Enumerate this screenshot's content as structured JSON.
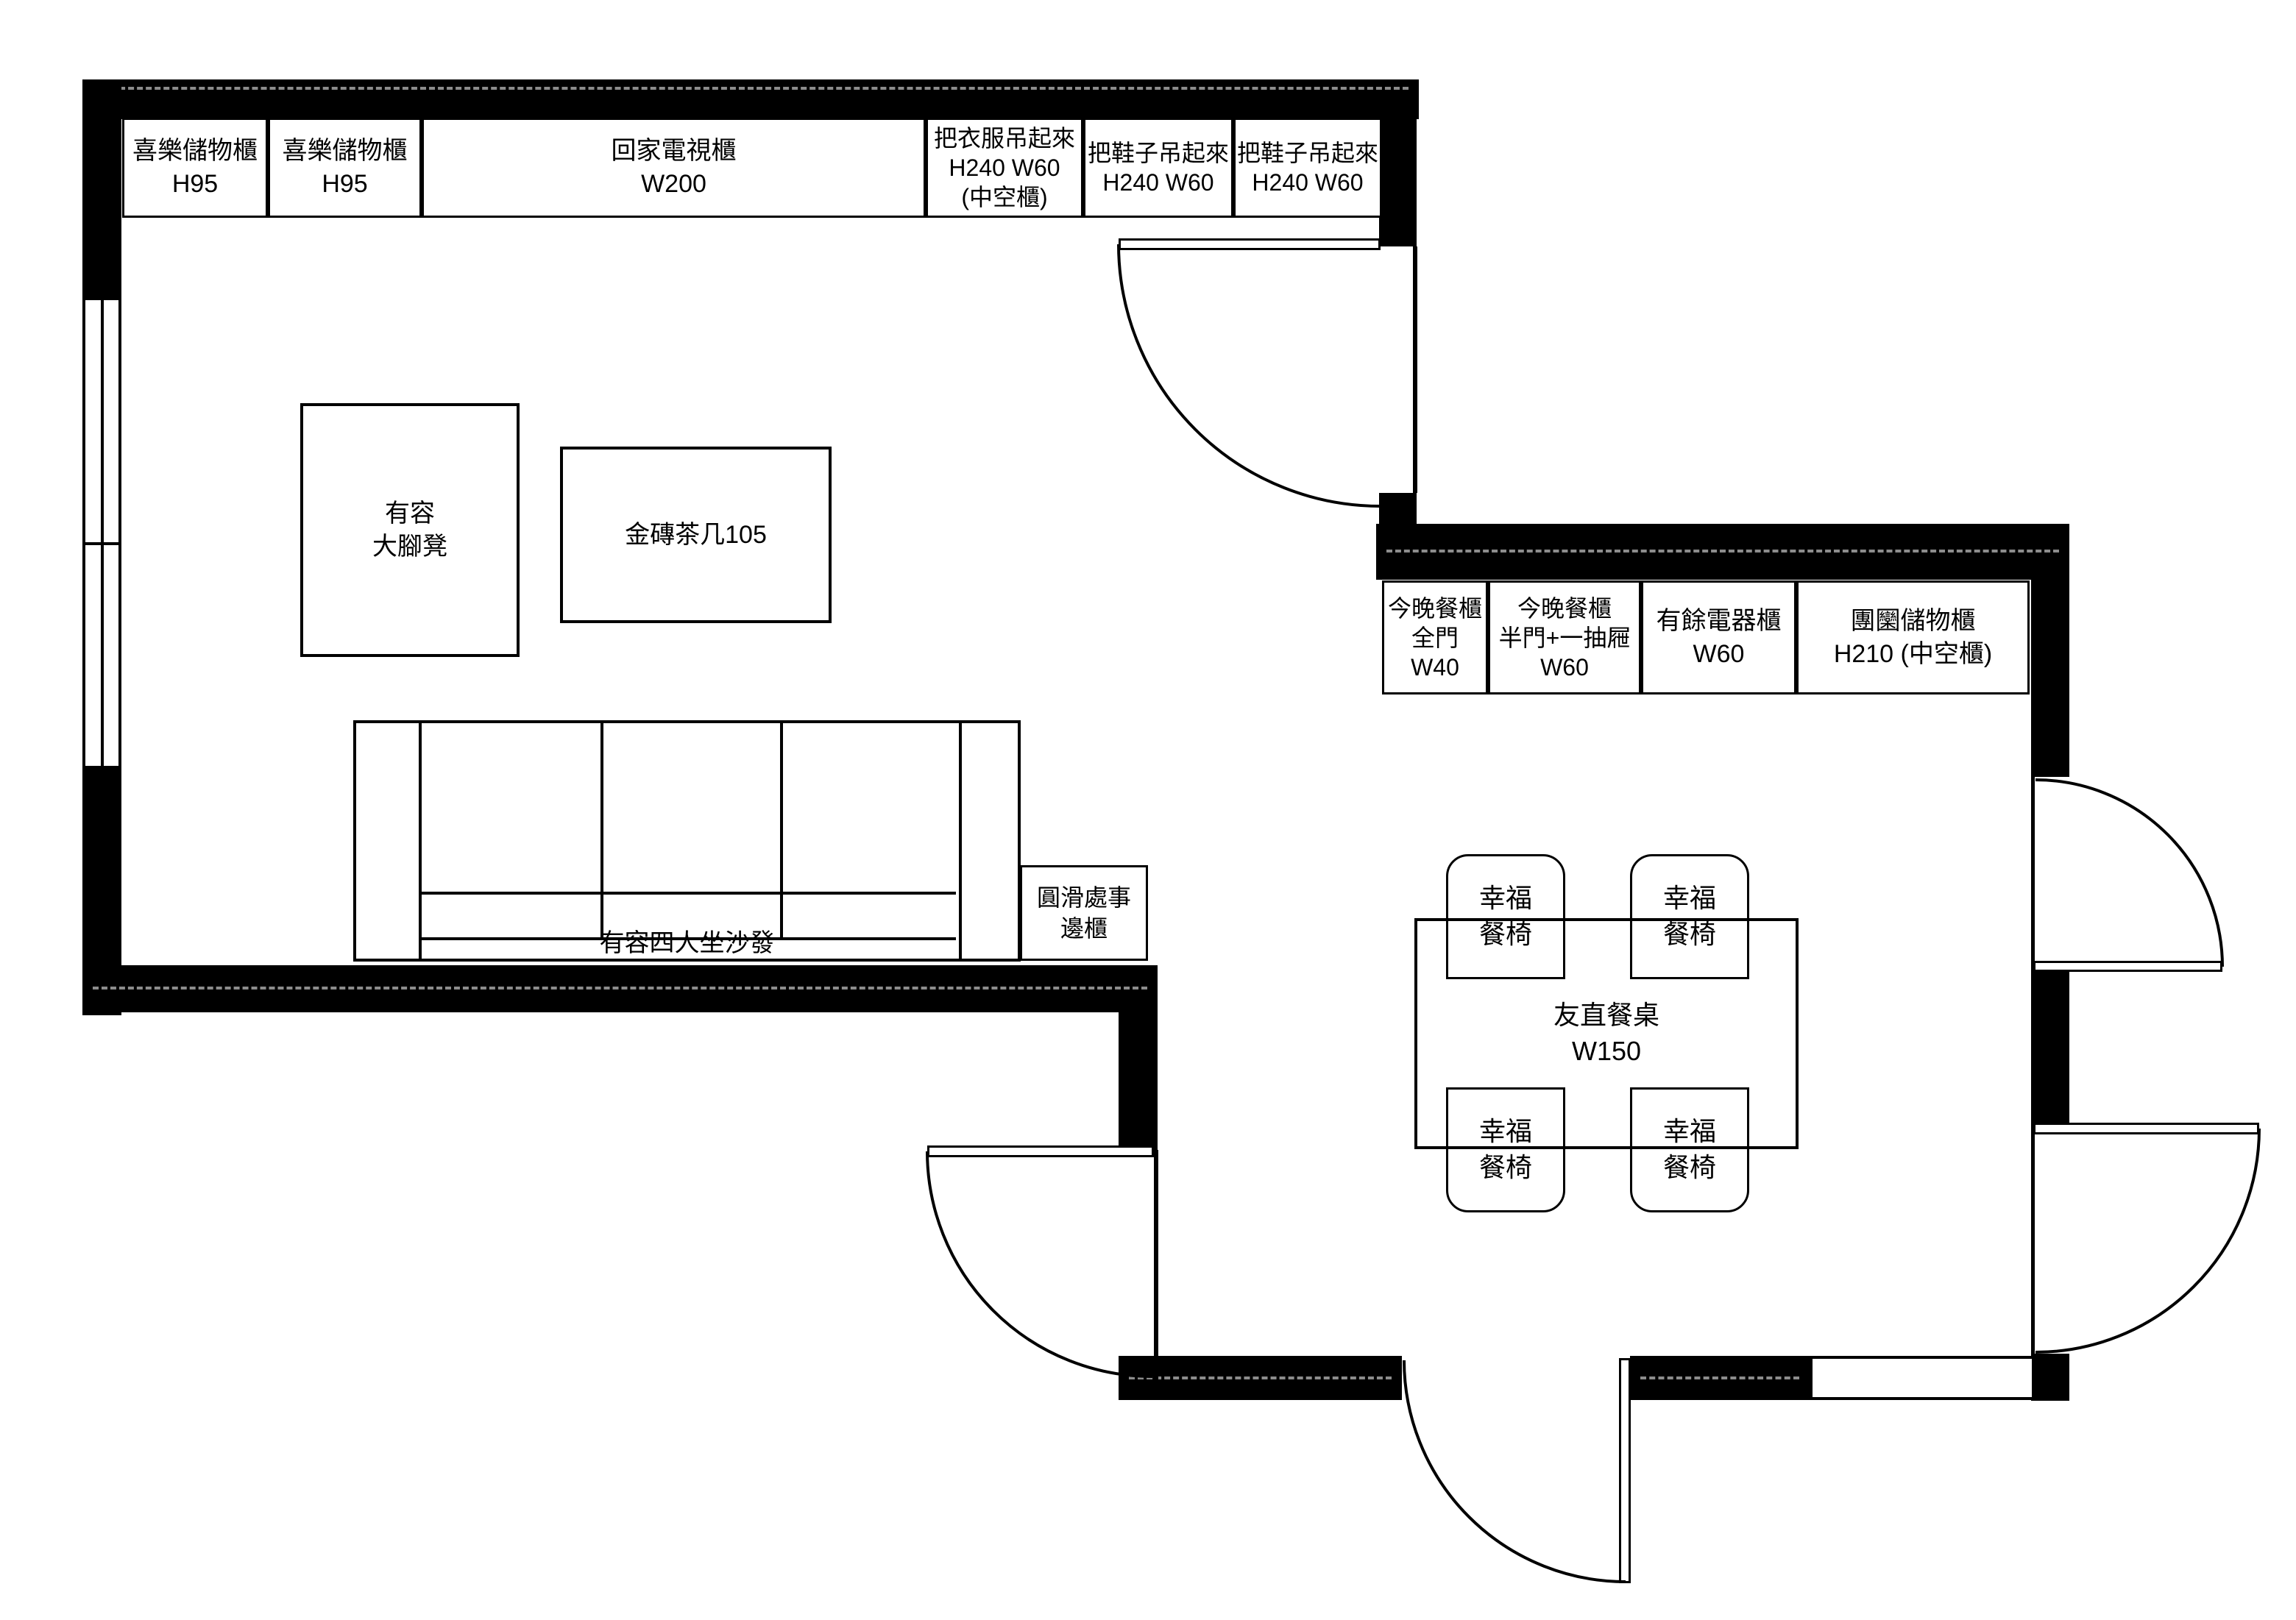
{
  "meta": {
    "background_color": "#ffffff",
    "wall_color": "#000000",
    "line_color": "#000000"
  },
  "living_room": {
    "wall_cabinets": [
      {
        "lines": [
          "喜樂儲物櫃",
          "H95"
        ]
      },
      {
        "lines": [
          "喜樂儲物櫃",
          "H95"
        ]
      },
      {
        "lines": [
          "回家電視櫃",
          "W200"
        ]
      },
      {
        "lines": [
          "把衣服吊起來",
          "H240 W60",
          "(中空櫃)"
        ]
      },
      {
        "lines": [
          "把鞋子吊起來",
          "H240 W60"
        ]
      },
      {
        "lines": [
          "把鞋子吊起來",
          "H240 W60"
        ]
      }
    ],
    "ottoman": {
      "lines": [
        "有容",
        "大腳凳"
      ]
    },
    "coffee_table": {
      "label": "金磚茶几105"
    },
    "sofa": {
      "label": "有容四人坐沙發"
    },
    "side_cabinet": {
      "lines": [
        "圓滑處事",
        "邊櫃"
      ]
    }
  },
  "dining_room": {
    "cabinets": [
      {
        "lines": [
          "今晚餐櫃",
          "全門",
          "W40"
        ]
      },
      {
        "lines": [
          "今晚餐櫃",
          "半門+一抽屜",
          "W60"
        ]
      },
      {
        "lines": [
          "有餘電器櫃",
          "W60"
        ]
      },
      {
        "lines": [
          "團圞儲物櫃",
          "H210 (中空櫃)"
        ]
      }
    ],
    "dining_table": {
      "lines": [
        "友直餐桌",
        "W150"
      ]
    },
    "chairs": [
      {
        "lines": [
          "幸福",
          "餐椅"
        ]
      },
      {
        "lines": [
          "幸福",
          "餐椅"
        ]
      },
      {
        "lines": [
          "幸福",
          "餐椅"
        ]
      },
      {
        "lines": [
          "幸福",
          "餐椅"
        ]
      }
    ]
  }
}
